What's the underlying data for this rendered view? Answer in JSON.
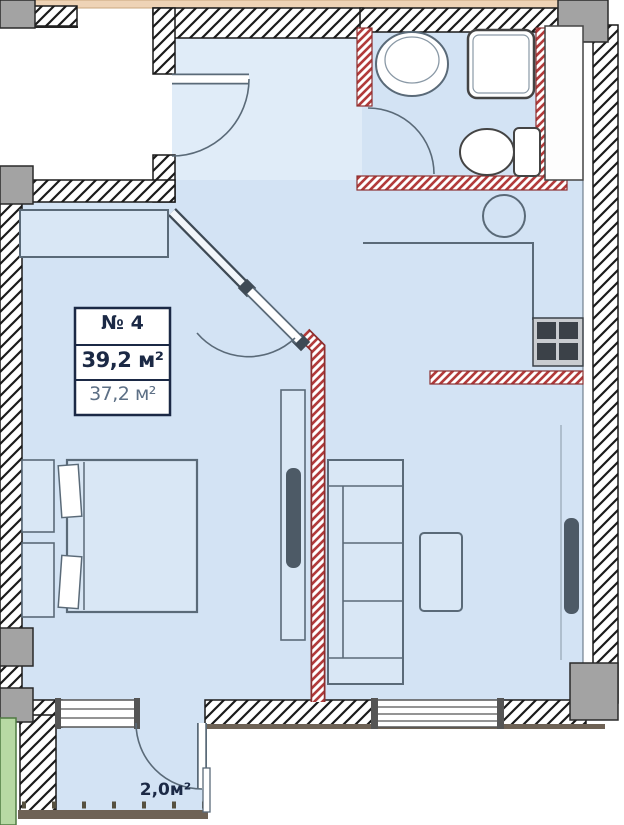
{
  "plan": {
    "unit_label": "№ 4",
    "total_area": "39,2 м²",
    "living_area": "37,2 м²",
    "balcony_area": "2,0м²"
  },
  "palette": {
    "floor_blue": "#d3e3f4",
    "hall_floor_blue": "#e0ecf8",
    "wall_line": "#1a1a1a",
    "partition_red": "#b23b3b",
    "column_gray": "#a3a3a3",
    "slab_tan": "#eed3b6",
    "balcony_green": "#b7d9a4",
    "furniture_line": "#5a6a78",
    "railing_brown": "#6e6255",
    "label_text_dark": "#1b2945",
    "label_text_muted": "#5c6f85"
  }
}
